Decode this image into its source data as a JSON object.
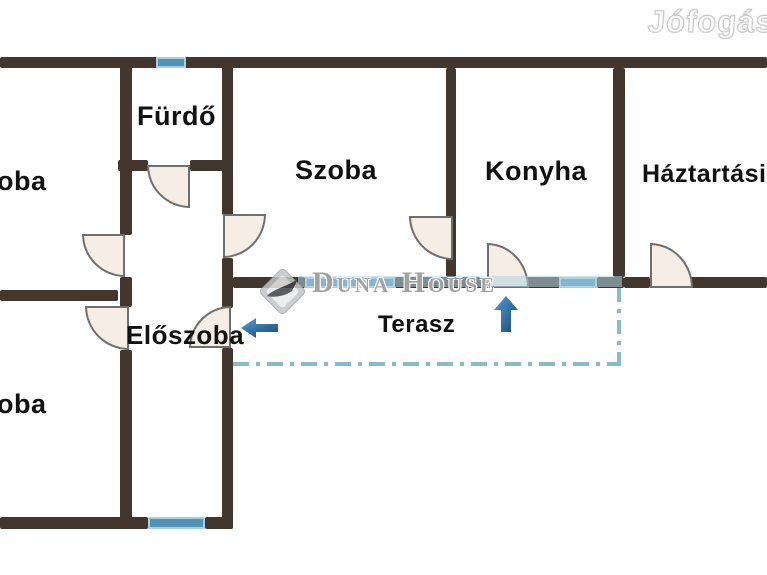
{
  "watermarks": {
    "jofogas": "Jófogás",
    "duna_house": "Duna House"
  },
  "rooms": {
    "room_top_left": {
      "label": "oba"
    },
    "furdo": {
      "label": "Fürdő"
    },
    "szoba": {
      "label": "Szoba"
    },
    "konyha": {
      "label": "Konyha"
    },
    "haztartasi": {
      "label": "Háztartási"
    },
    "eloszoba": {
      "label": "Előszoba"
    },
    "room_bottom_left": {
      "label": "oba"
    },
    "terasz": {
      "label": "Terasz"
    }
  },
  "colors": {
    "wall": "#42362d",
    "window_fill": "#4f94b8",
    "window_border": "#a9cfdf",
    "door_fill": "#f6eee4",
    "terrace_line": "#85bcc8",
    "arrow_light": "#56a0d8",
    "arrow_dark": "#1c4e7d",
    "watermark_text": "#a2a2a2",
    "watermark_stripe": "#aed3e4"
  }
}
